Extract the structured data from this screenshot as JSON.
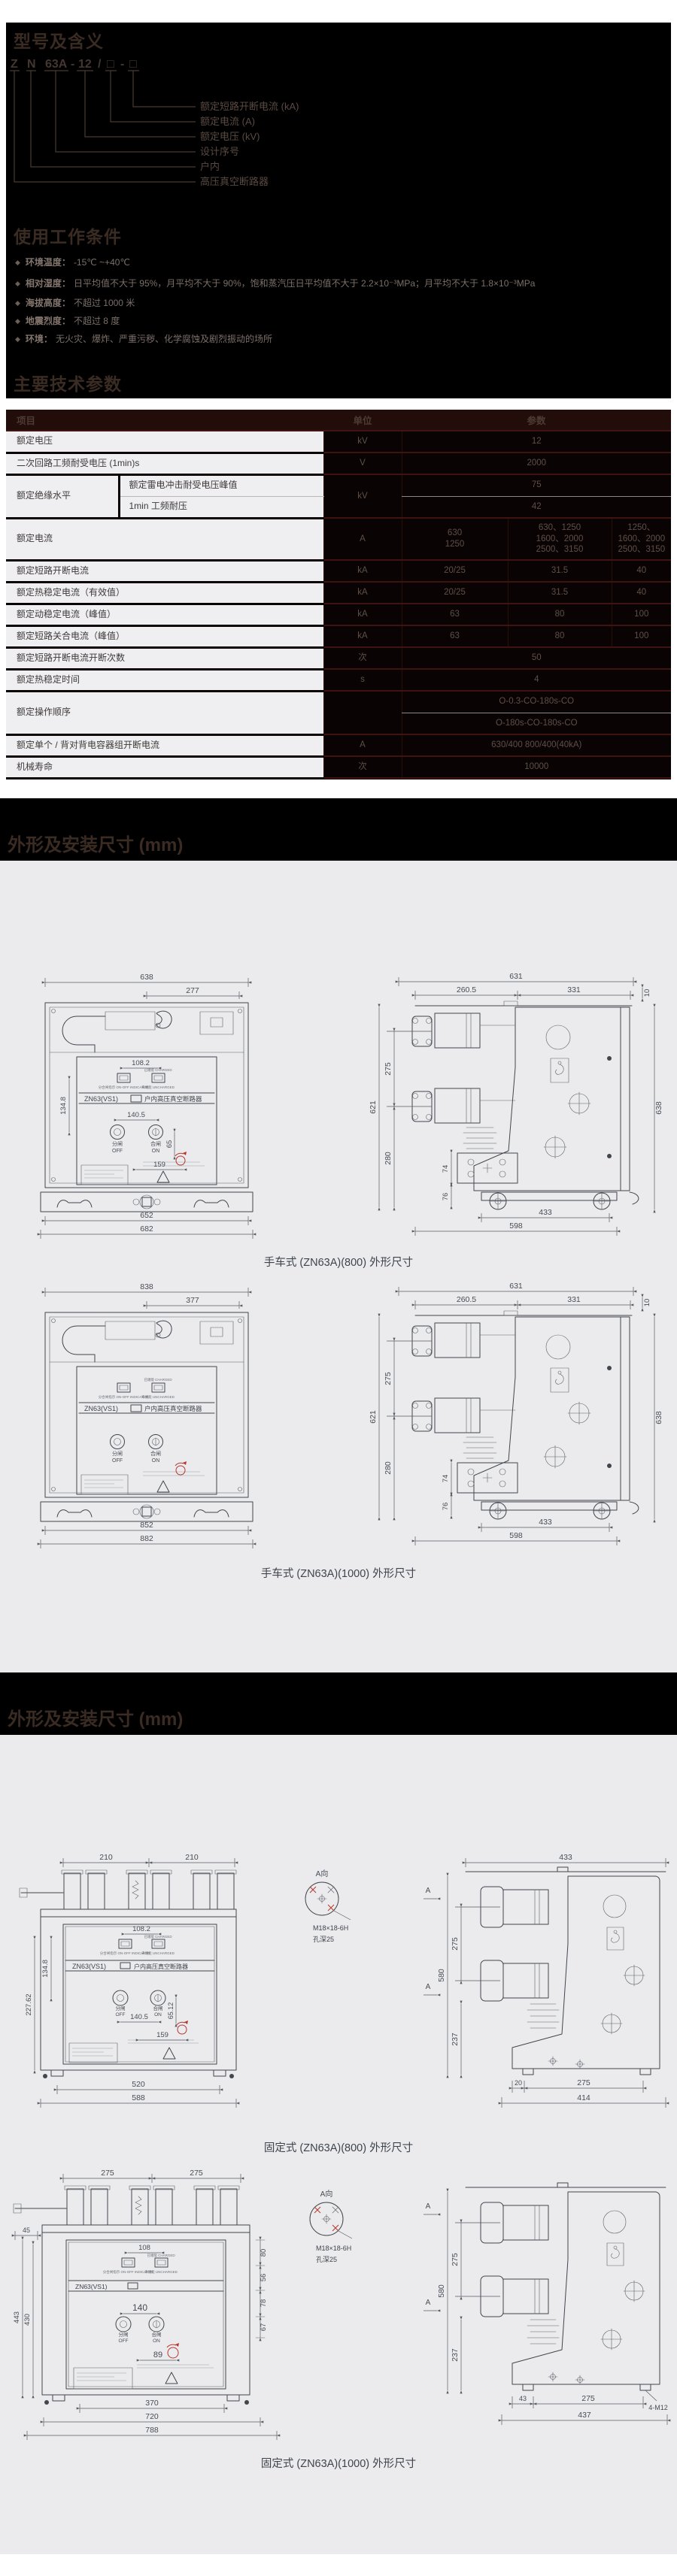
{
  "model": {
    "title": "型号及含义",
    "code_parts": [
      "Z",
      "N",
      "63A",
      "-",
      "12",
      "/",
      "□",
      "-",
      "□"
    ],
    "labels": [
      "额定短路开断电流 (kA)",
      "额定电流 (A)",
      "额定电压 (kV)",
      "设计序号",
      "户内",
      "高压真空断路器"
    ]
  },
  "conditions": {
    "title": "使用工作条件",
    "bullet": "◆",
    "items": [
      {
        "label": "环境温度：",
        "text": "-15℃ ~+40℃"
      },
      {
        "label": "相对湿度：",
        "text": "日平均值不大于 95%，月平均不大于 90%，饱和蒸汽压日平均值不大于 2.2×10⁻³MPa；月平均不大于 1.8×10⁻³MPa"
      },
      {
        "label": "海拔高度：",
        "text": "不超过 1000 米"
      },
      {
        "label": "地震烈度：",
        "text": "不超过 8 度"
      },
      {
        "label": "环境：",
        "text": "无火灾、爆炸、严重污秽、化学腐蚀及剧烈振动的场所"
      }
    ]
  },
  "specs": {
    "title": "主要技术参数",
    "headers": {
      "item": "项目",
      "unit": "单位",
      "param": "参数"
    },
    "rows": {
      "voltage": {
        "item": "额定电压",
        "unit": "kV",
        "value": "12"
      },
      "secondary": {
        "item": "二次回路工频耐受电压 (1min)s",
        "unit": "V",
        "value": "2000"
      },
      "insulation": {
        "item": "额定绝缘水平",
        "sub1": "额定雷电冲击耐受电压峰值",
        "sub2": "1min 工频耐压",
        "unit": "kV",
        "v1": "75",
        "v2": "42"
      },
      "current": {
        "item": "额定电流",
        "unit": "A",
        "v1": "630\n1250",
        "v2": "630、1250\n1600、2000\n2500、3150",
        "v3": "1250、\n1600、2000\n2500、3150"
      },
      "breaking": {
        "item": "额定短路开断电流",
        "unit": "kA",
        "v1": "20/25",
        "v2": "31.5",
        "v3": "40"
      },
      "thermal": {
        "item": "额定热稳定电流（有效值）",
        "unit": "kA",
        "v1": "20/25",
        "v2": "31.5",
        "v3": "40"
      },
      "dynamic": {
        "item": "额定动稳定电流（峰值）",
        "unit": "kA",
        "v1": "63",
        "v2": "80",
        "v3": "100"
      },
      "making": {
        "item": "额定短路关合电流（峰值）",
        "unit": "kA",
        "v1": "63",
        "v2": "80",
        "v3": "100"
      },
      "break_times": {
        "item": "额定短路开断电流开断次数",
        "unit": "次",
        "value": "50"
      },
      "thermal_time": {
        "item": "额定热稳定时间",
        "unit": "s",
        "value": "4"
      },
      "sequence": {
        "item": "额定操作顺序",
        "unit": "",
        "v1": "O-0.3-CO-180s-CO",
        "v2": "O-180s-CO-180s-CO"
      },
      "capacitor": {
        "item": "额定单个 / 背对背电容器组开断电流",
        "unit": "A",
        "value": "630/400 800/400(40kA)"
      },
      "mech_life": {
        "item": "机械寿命",
        "unit": "次",
        "value": "10000"
      }
    }
  },
  "dims1": {
    "title": "外形及安装尺寸 (mm)"
  },
  "dims2": {
    "title": "外形及安装尺寸 (mm)"
  },
  "d1": {
    "caption": "手车式 (ZN63A)(800) 外形尺寸",
    "plate": "ZN63(VS1)",
    "plate2": "户内高压真空断路器",
    "off_cn": "分闸",
    "off_en": "OFF",
    "on_cn": "合闸",
    "on_en": "ON",
    "t_charged": "已储能 CHARGED",
    "t_indicator": "分合闸指示 ON-OFF INDICATOR",
    "t_uncharged": "未储能 UNCHARGED",
    "d_top": "638",
    "d_top2": "277",
    "d_btn": "108.2",
    "d_v1": "134.8",
    "d_ops": "140.5",
    "d_v2": "65",
    "d_h2": "159",
    "d_base1": "652",
    "d_base2": "682",
    "s_top": "631",
    "s_t1": "260.5",
    "s_t2": "331",
    "s_edge": "10",
    "s_h": "621",
    "s_p": "275",
    "s_l": "280",
    "s_r": "638",
    "s_a1": "74",
    "s_a2": "76",
    "s_b1": "433",
    "s_b2": "598"
  },
  "d2": {
    "caption": "手车式 (ZN63A)(1000) 外形尺寸",
    "plate": "ZN63(VS1)",
    "plate2": "户内高压真空断路器",
    "off_cn": "分闸",
    "off_en": "OFF",
    "on_cn": "合闸",
    "on_en": "ON",
    "t_charged": "已储能 CHARGED",
    "t_indicator": "分合闸指示 ON-OFF INDICATOR",
    "t_uncharged": "未储能 UNCHARGED",
    "d_top": "838",
    "d_top2": "377",
    "d_base1": "852",
    "d_base2": "882",
    "s_top": "631",
    "s_t1": "260.5",
    "s_t2": "331",
    "s_edge": "10",
    "s_h": "621",
    "s_p": "275",
    "s_l": "280",
    "s_r": "638",
    "s_a1": "74",
    "s_a2": "76",
    "s_b1": "433",
    "s_b2": "598"
  },
  "d3": {
    "caption": "固定式 (ZN63A)(800) 外形尺寸",
    "plate": "ZN63(VS1)",
    "plate2": "户内高压真空断路器",
    "off_cn": "分闸",
    "off_en": "OFF",
    "on_cn": "合闸",
    "on_en": "ON",
    "t_charged": "已储能 CHARGED",
    "t_indicator": "分合闸指示 ON-OFF INDICATOR",
    "t_uncharged": "未储能 UNCHARGED",
    "detail_title": "A向",
    "detail_bolt": "M18×18-6H",
    "detail_depth": "孔深25",
    "section_mark": "A",
    "d_t1": "210",
    "d_t2": "210",
    "d_btn": "108.2",
    "d_v1": "134.8",
    "d_ops": "140.5",
    "d_v2": "65.12",
    "d_h2": "159",
    "d_vL": "227.62",
    "d_base1": "520",
    "d_base2": "588",
    "s_top": "433",
    "s_h": "580",
    "s_p": "275",
    "s_l": "237",
    "s_b0": "20",
    "s_b1": "275",
    "s_b2": "414"
  },
  "d4": {
    "caption": "固定式 (ZN63A)(1000) 外形尺寸",
    "plate": "ZN63(VS1)",
    "off_cn": "分闸",
    "off_en": "OFF",
    "on_cn": "合闸",
    "on_en": "ON",
    "t_charged": "已储能 CHARGED",
    "t_indicator": "分合闸指示 ON-OFF INDICATOR",
    "t_uncharged": "未储能 UNCHARGED",
    "detail_title": "A向",
    "detail_bolt": "M18×18-6H",
    "detail_depth": "孔深25",
    "section_mark": "A",
    "d_t1": "275",
    "d_t2": "275",
    "d_left": "45",
    "d_btn": "108",
    "d_ops": "140",
    "d_h2": "89",
    "rs1": "80",
    "rs2": "56",
    "rs3": "78",
    "rs4": "67",
    "d_vL1": "443",
    "d_vL2": "430",
    "d_base1": "370",
    "d_base2": "720",
    "d_base3": "788",
    "s_h": "580",
    "s_p": "275",
    "s_l": "237",
    "s_b0": "43",
    "s_b1": "275",
    "s_b2": "437",
    "s_bolt": "4-M12"
  }
}
